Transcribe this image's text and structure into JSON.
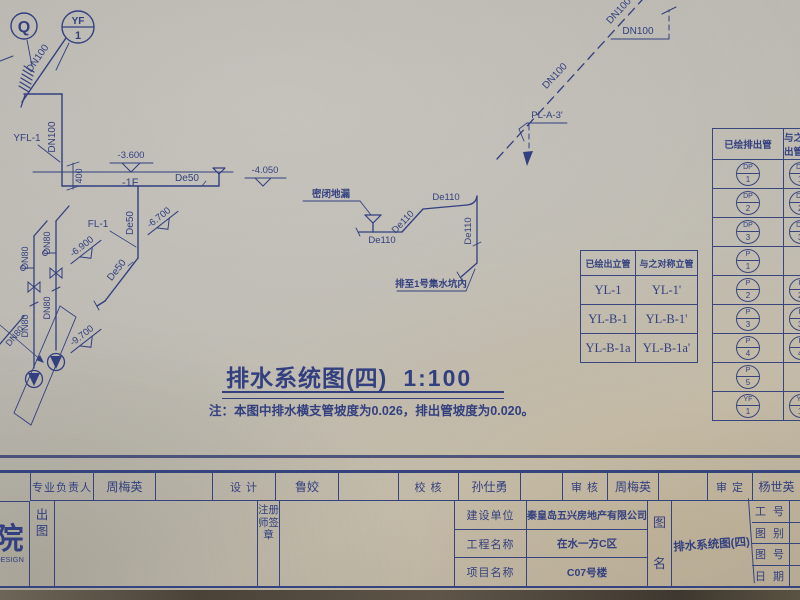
{
  "colors": {
    "ink": "#2e3c7e",
    "paper": "#bdbab2"
  },
  "drawing": {
    "labels": {
      "q": "Q",
      "yf_top": "YF",
      "yf_num": "1",
      "dn100": "DN100",
      "de50": "De50",
      "dn80": "DN80",
      "de110": "De110",
      "yfl1": "YFL-1",
      "fl1": "FL-1",
      "pl_a_3": "PL-A-3'",
      "elev_3600": "-3.600",
      "floor": "-1F",
      "dim400": "400",
      "elev_4050": "-4.050",
      "elev_6700": "-6.700",
      "elev_6900": "-6.900",
      "elev_9700": "-9.700",
      "floor_drain": "密闭地漏",
      "to_sump": "排至1号集水坑内"
    }
  },
  "riser_table": {
    "headers": [
      "已绘出立管",
      "与之对称立管"
    ],
    "rows": [
      [
        "YL-1",
        "YL-1'"
      ],
      [
        "YL-B-1",
        "YL-B-1'"
      ],
      [
        "YL-B-1a",
        "YL-B-1a'"
      ]
    ]
  },
  "outlet_table": {
    "headers": [
      "已绘排出管",
      "与之对称排出管"
    ],
    "rows": [
      {
        "l_top": "DP",
        "l_num": "1",
        "r_top": "DP",
        "r_num": "1'"
      },
      {
        "l_top": "DP",
        "l_num": "2",
        "r_top": "DP",
        "r_num": "2'"
      },
      {
        "l_top": "DP",
        "l_num": "3",
        "r_top": "DP",
        "r_num": "3'"
      },
      {
        "l_top": "P",
        "l_num": "1"
      },
      {
        "l_top": "P",
        "l_num": "2",
        "r_top": "P",
        "r_num": "2'"
      },
      {
        "l_top": "P",
        "l_num": "3",
        "r_top": "P",
        "r_num": "3'"
      },
      {
        "l_top": "P",
        "l_num": "4",
        "r_top": "P",
        "r_num": "4'"
      },
      {
        "l_top": "P",
        "l_num": "5"
      },
      {
        "l_top": "YF",
        "l_num": "1",
        "r_top": "YF",
        "r_num": "1'"
      }
    ]
  },
  "title": {
    "text": "排水系统图(四)",
    "scale": "1:100"
  },
  "note": "注：本图中排水横支管坡度为0.026，排出管坡度为0.020。",
  "titleblock": {
    "row1": [
      {
        "label": "专业负责人",
        "value": "周梅英"
      },
      {
        "label": "设  计",
        "value": "鲁姣"
      },
      {
        "label": "校  核",
        "value": "孙仕勇"
      },
      {
        "label": "审  核",
        "value": "周梅英"
      },
      {
        "label": "审  定",
        "value": "杨世英"
      }
    ],
    "institute": {
      "char": "院",
      "latin": "DESIGN"
    },
    "chutu": "出图",
    "seal": "注册师签章",
    "project_rows": [
      {
        "label": "建设单位",
        "value": "秦皇岛五兴房地产有限公司"
      },
      {
        "label": "工程名称",
        "value": "在水一方C区"
      },
      {
        "label": "项目名称",
        "value": "C07号楼"
      }
    ],
    "tuming": "图名",
    "drawing_name": "排水系统图(四)",
    "right_rows": [
      "工 号",
      "图 别",
      "图 号",
      "日 期"
    ]
  }
}
